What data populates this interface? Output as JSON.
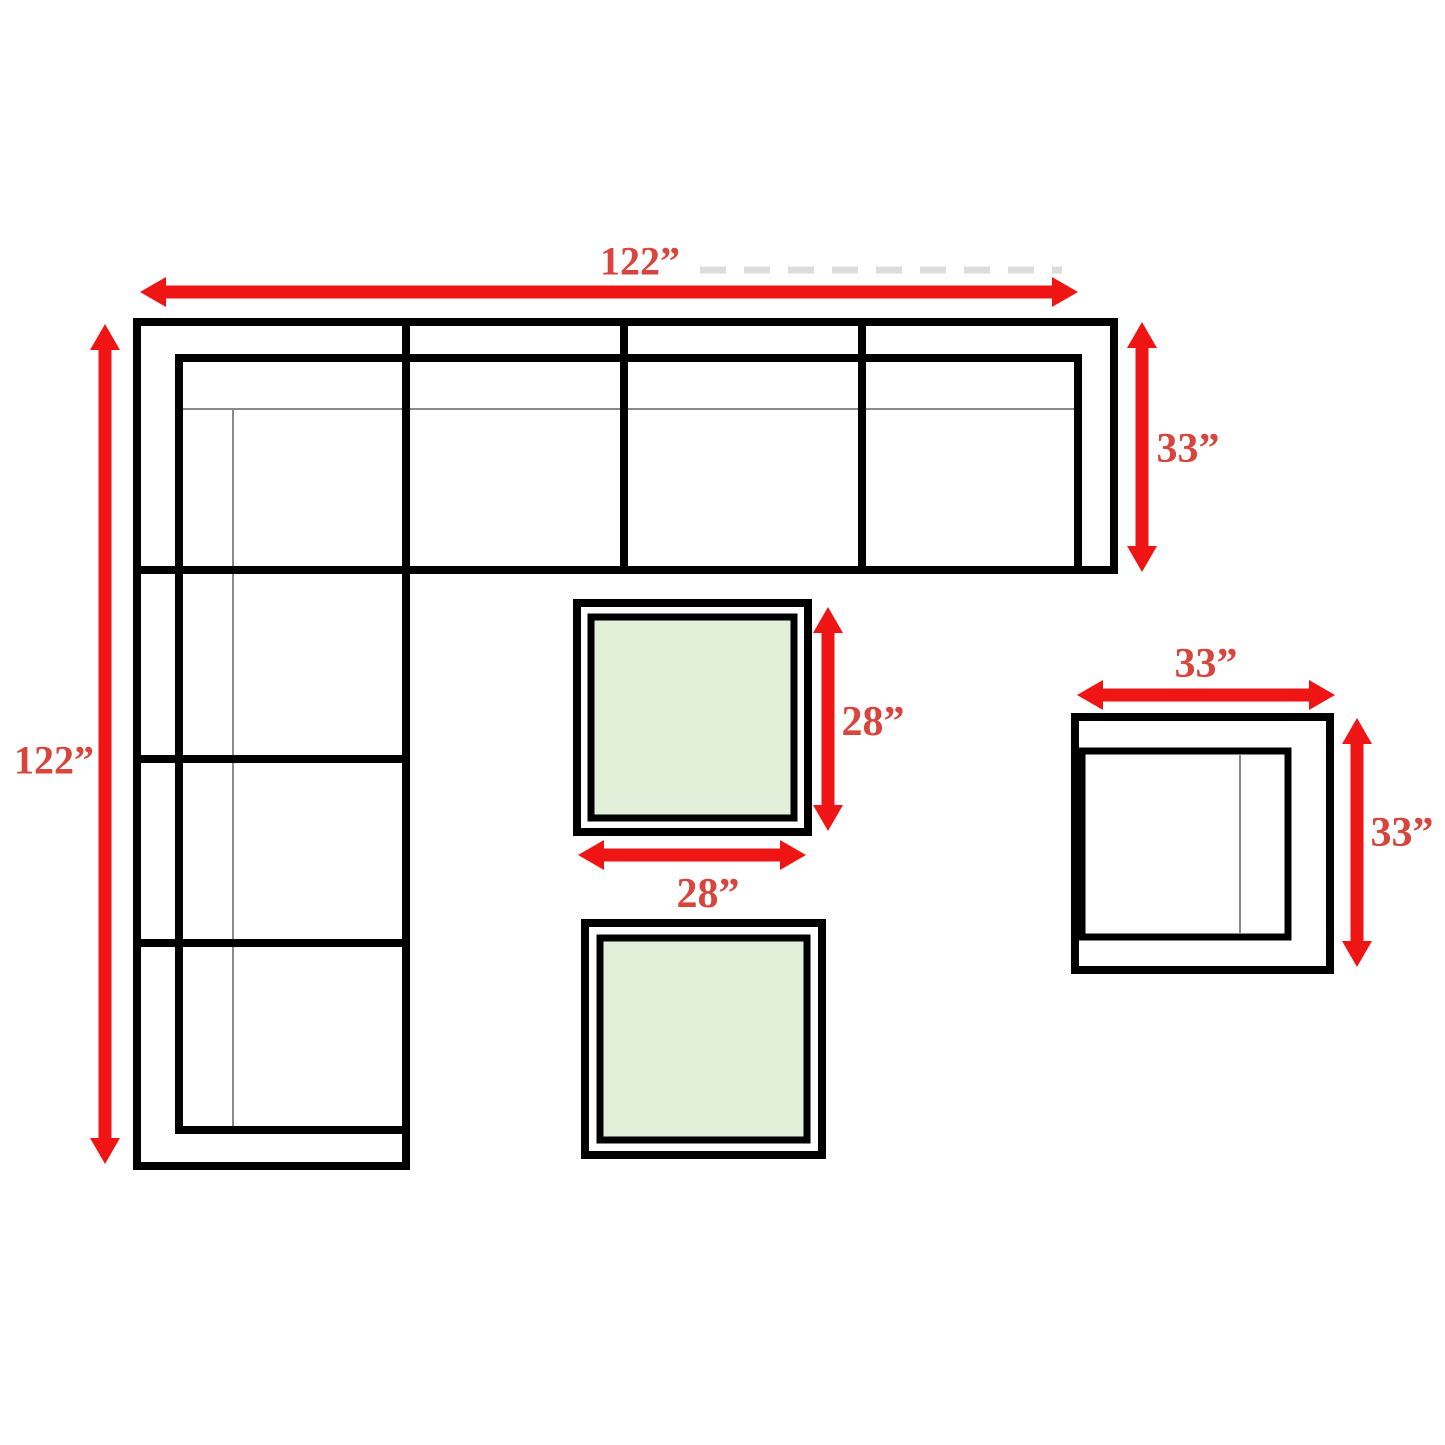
{
  "page": {
    "background": "#ffffff",
    "canvas_width": 1445,
    "canvas_height": 1445
  },
  "colors": {
    "outline": "#000000",
    "thin_line": "#8a8a8a",
    "arrow": "#ef1515",
    "label_text": "#d8453c",
    "table_top_fill": "#e2efd9",
    "white_fill": "#ffffff",
    "ghost_line": "#dcdcdc"
  },
  "stroke_widths": {
    "thick": 8,
    "medium": 7,
    "thin": 2,
    "arrow_shaft": 13,
    "ghost": 7
  },
  "arrow_geometry": {
    "head_length": 26,
    "head_half_width": 15
  },
  "dimensions_summary": {
    "sofa_width": "122”",
    "sofa_height": "122”",
    "sofa_seat_depth": "33”",
    "table_width": "28”",
    "table_height": "28”",
    "chair_width": "33”",
    "chair_height": "33”"
  },
  "figures": {
    "sofa": {
      "name": "sectional-sofa-outline",
      "outer_path": "M137,322 H1114 V570 H406 V1166 H137 Z",
      "inner_backrest_path": "M1078,570 V358 H179 V1130 H406",
      "divider_paths": [
        "M406,322 V1166",
        "M624,322 V570",
        "M862,322 V570",
        "M137,570 H1114",
        "M137,759 H406",
        "M137,943 H406"
      ],
      "cushion_paths": [
        "M180,409 H1078",
        "M233,409 V1130"
      ]
    },
    "tables": [
      {
        "name": "ottoman-table-1",
        "outer": {
          "x": 577,
          "y": 603,
          "w": 231,
          "h": 229
        },
        "inner": {
          "x": 591,
          "y": 617,
          "w": 203,
          "h": 201
        }
      },
      {
        "name": "ottoman-table-2",
        "outer": {
          "x": 585,
          "y": 923,
          "w": 237,
          "h": 232
        },
        "inner": {
          "x": 600,
          "y": 938,
          "w": 207,
          "h": 202
        }
      }
    ],
    "chair": {
      "name": "armchair-outline",
      "outer": {
        "x": 1075,
        "y": 717,
        "w": 255,
        "h": 253
      },
      "seat": {
        "x": 1082,
        "y": 751,
        "w": 206,
        "h": 186
      },
      "cushion_line": "M1240,754 V934"
    },
    "ghost_dash_line": "M700,270 H1062"
  },
  "arrows": [
    {
      "name": "arrow-sofa-width",
      "x1": 140,
      "y1": 292,
      "x2": 1078,
      "y2": 292
    },
    {
      "name": "arrow-sofa-height",
      "x1": 105,
      "y1": 324,
      "x2": 105,
      "y2": 1164
    },
    {
      "name": "arrow-sofa-depth",
      "x1": 1142,
      "y1": 322,
      "x2": 1142,
      "y2": 572
    },
    {
      "name": "arrow-table-height",
      "x1": 828,
      "y1": 607,
      "x2": 828,
      "y2": 831
    },
    {
      "name": "arrow-table-width",
      "x1": 578,
      "y1": 855,
      "x2": 806,
      "y2": 855
    },
    {
      "name": "arrow-chair-width",
      "x1": 1077,
      "y1": 695,
      "x2": 1335,
      "y2": 695
    },
    {
      "name": "arrow-chair-height",
      "x1": 1357,
      "y1": 718,
      "x2": 1357,
      "y2": 967
    }
  ],
  "labels": [
    {
      "name": "label-sofa-width",
      "text": "122”",
      "x": 640,
      "y": 261,
      "size": 40
    },
    {
      "name": "label-sofa-height",
      "text": "122”",
      "x": 54,
      "y": 760,
      "size": 40
    },
    {
      "name": "label-sofa-depth",
      "text": "33”",
      "x": 1188,
      "y": 449,
      "size": 42
    },
    {
      "name": "label-chair-width",
      "text": "33”",
      "x": 1206,
      "y": 664,
      "size": 42
    },
    {
      "name": "label-chair-height",
      "text": "33”",
      "x": 1402,
      "y": 833,
      "size": 42
    },
    {
      "name": "label-table-height",
      "text": "28”",
      "x": 873,
      "y": 722,
      "size": 42
    },
    {
      "name": "label-table-width",
      "text": "28”",
      "x": 708,
      "y": 894,
      "size": 42
    }
  ]
}
